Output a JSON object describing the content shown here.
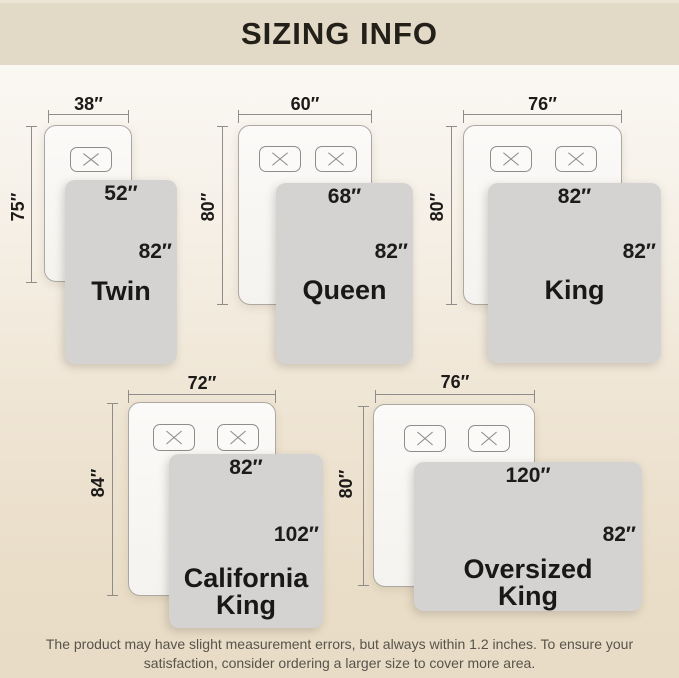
{
  "header": {
    "title": "SIZING INFO"
  },
  "sizes": [
    {
      "id": "twin",
      "name": "Twin",
      "bed_width": "38″",
      "bed_length": "75″",
      "blanket_width": "52″",
      "blanket_length": "82″",
      "pillows": 1
    },
    {
      "id": "queen",
      "name": "Queen",
      "bed_width": "60″",
      "bed_length": "80″",
      "blanket_width": "68″",
      "blanket_length": "82″",
      "pillows": 2
    },
    {
      "id": "king",
      "name": "King",
      "bed_width": "76″",
      "bed_length": "80″",
      "blanket_width": "82″",
      "blanket_length": "82″",
      "pillows": 2
    },
    {
      "id": "california-king",
      "name": "California King",
      "bed_width": "72″",
      "bed_length": "84″",
      "blanket_width": "82″",
      "blanket_length": "102″",
      "pillows": 2
    },
    {
      "id": "oversized-king",
      "name": "Oversized King",
      "bed_width": "76″",
      "bed_length": "80″",
      "blanket_width": "120″",
      "blanket_length": "82″",
      "pillows": 2
    }
  ],
  "footer": {
    "line1": "The product may have slight measurement errors, but always within 1.2 inches. To ensure your",
    "line2": "satisfaction, consider ordering a larger size to cover more area."
  },
  "colors": {
    "header_bg": "#e3d9c7",
    "page_gradient_top": "#fcfaf7",
    "page_gradient_bottom": "#e8dcc6",
    "blanket": "#d4d3d1",
    "bed_border": "#aba8a2",
    "dim_line": "#8f8d8a",
    "label_text": "#1c1b19",
    "footer_text": "#57534b"
  }
}
